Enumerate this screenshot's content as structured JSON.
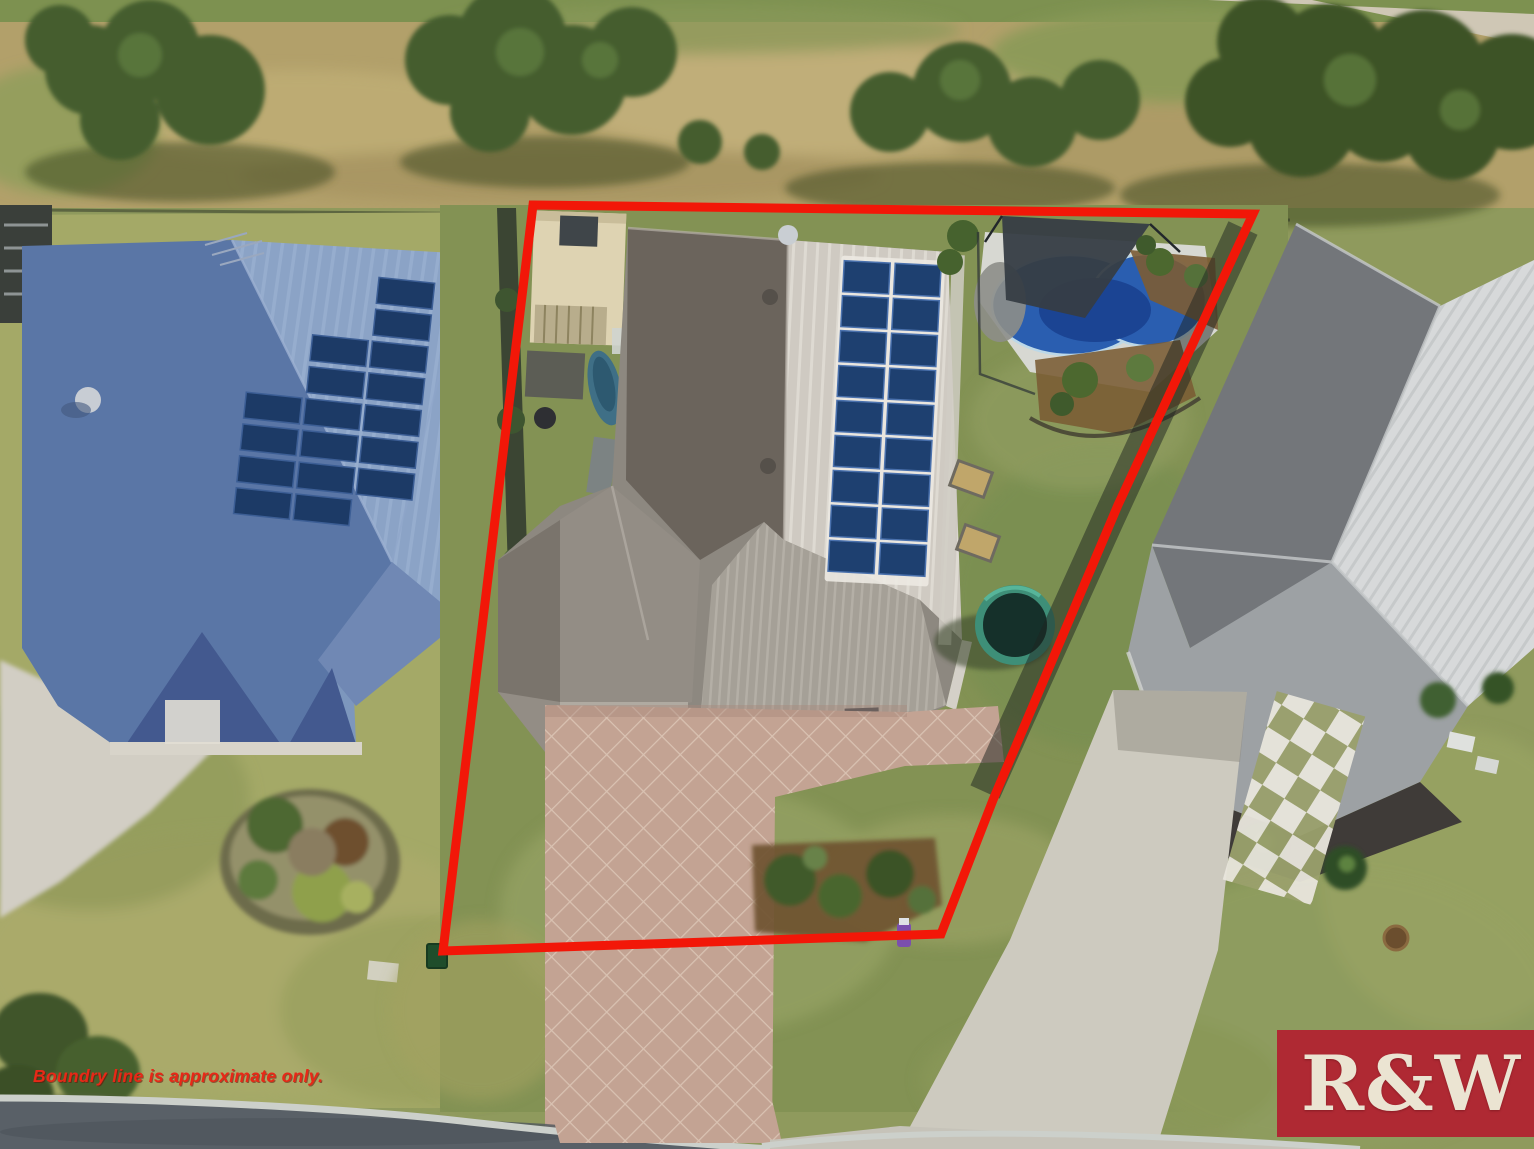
{
  "photo": {
    "type": "aerial-real-estate-photo",
    "scene": {
      "subject_lot": "single-storey grey-roof house with rooftop solar array, shed, paver driveway, swimming pool with shade sail and trampoline, outlined in red",
      "left_neighbor": "blue-roof house with solar panels and round garden island",
      "right_neighbor": "grey/white-roof house with long concrete driveway and stepping stones",
      "top": "bushland reserve with gum trees and dry grass",
      "bottom": "suburban street with concrete kerb"
    },
    "boundary": {
      "color": "#f21708",
      "stroke_width": 9,
      "points": "533,205 1253,214 1118,505 993,800 941,934 443,951"
    },
    "disclaimer": {
      "text": "Boundry line is approximate only.",
      "color": "#e82817"
    },
    "logo": {
      "text": "R&W",
      "background": "#b4162c",
      "text_color": "#ebe4d2"
    },
    "palette": {
      "bushland_grass": "#b2a06a",
      "lawn_green": "#95a062",
      "left_roof_lit": "#8da5c8",
      "left_roof_shadow": "#5a76a6",
      "solar_panel_navy": "#1d3a63",
      "subject_roof_dark": "#6b645c",
      "subject_roof_lit": "#a7a199",
      "right_roof_white": "#d8dadb",
      "right_roof_dark": "#73767a",
      "pool_water": "#2a5eb0",
      "shade_sail": "#363d44",
      "paver_driveway": "#c3a393",
      "concrete_driveway": "#cdcabf",
      "road_asphalt": "#596067"
    }
  }
}
